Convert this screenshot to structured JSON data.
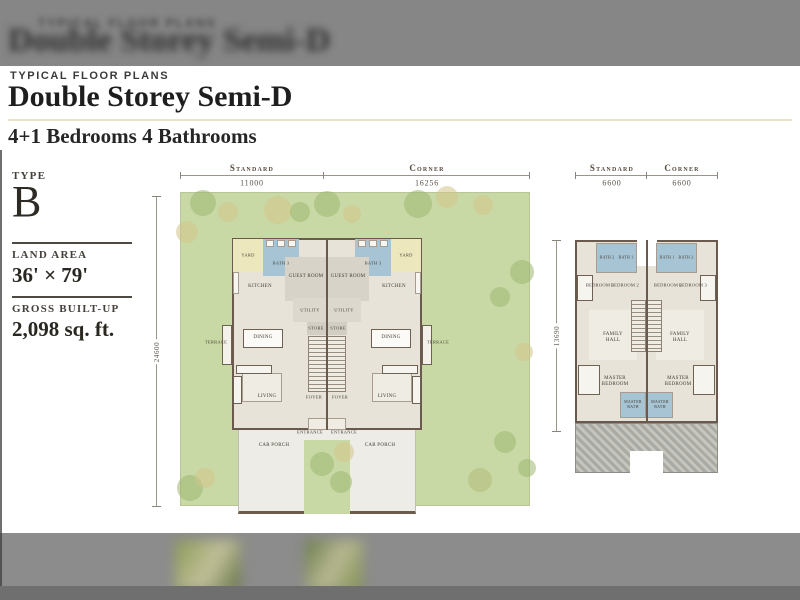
{
  "colors": {
    "accent_rule": "#eae2cb",
    "garden": "#c9d9a5",
    "floor": "#e8e3d8",
    "wall": "#695a4d",
    "yard": "#ece7bd",
    "bath_blue": "#a6c4d4",
    "car_porch": "#edece6",
    "hatch_gray": "#aaaaa4",
    "tree_g": "#9cb873",
    "tree_t": "#d2c48b",
    "tree_o": "#b2b97c"
  },
  "background": {
    "header_eyebrow_blur": "TYPICAL FLOOR PLANS",
    "header_title_blur": "Double Storey Semi-D"
  },
  "page": {
    "eyebrow": "TYPICAL FLOOR PLANS",
    "title": "Double Storey Semi-D",
    "subtitle": "4+1 Bedrooms 4 Bathrooms"
  },
  "panel": {
    "type_label": "TYPE",
    "type_value": "B",
    "land_area_label": "LAND AREA",
    "land_area_value": "36' × 79'",
    "built_up_label": "GROSS BUILT-UP",
    "built_up_value": "2,098 sq. ft."
  },
  "ground_plan": {
    "dims": {
      "standard_label": "Standard",
      "standard_value": "11000",
      "corner_label": "Corner",
      "corner_value": "16256",
      "depth_value": "24600"
    },
    "rects": [
      {
        "n": "garden",
        "x": 0,
        "y": 32,
        "w": 350,
        "h": 314,
        "f": "#c9d9a5",
        "cls": "garden"
      },
      {
        "n": "car-porch",
        "x": 58,
        "y": 265,
        "w": 178,
        "h": 89,
        "f": "#edece6",
        "cls": "porch"
      },
      {
        "n": "porch-green-strip",
        "x": 124,
        "y": 280,
        "w": 46,
        "h": 74,
        "f": "#c9d9a5"
      },
      {
        "n": "building-footprint",
        "x": 52,
        "y": 78,
        "w": 190,
        "h": 192,
        "f": "#e8e3d8",
        "cls": "wall2"
      },
      {
        "n": "yard-left",
        "x": 53,
        "y": 79,
        "w": 30,
        "h": 33,
        "f": "#ece7bd"
      },
      {
        "n": "yard-right",
        "x": 211,
        "y": 79,
        "w": 30,
        "h": 33,
        "f": "#ece7bd"
      },
      {
        "n": "bath3-left",
        "x": 83,
        "y": 79,
        "w": 36,
        "h": 37,
        "f": "#a6c4d4"
      },
      {
        "n": "bath3-right",
        "x": 175,
        "y": 79,
        "w": 36,
        "h": 37,
        "f": "#a6c4d4"
      },
      {
        "n": "wc-fixture",
        "x": 86,
        "y": 80,
        "w": 8,
        "h": 7,
        "f": "#f7f6f1",
        "cls": "thin"
      },
      {
        "n": "wc-fixture",
        "x": 97,
        "y": 80,
        "w": 8,
        "h": 7,
        "f": "#f7f6f1",
        "cls": "thin"
      },
      {
        "n": "wc-fixture",
        "x": 108,
        "y": 80,
        "w": 8,
        "h": 7,
        "f": "#f7f6f1",
        "cls": "thin"
      },
      {
        "n": "wc-fixture",
        "x": 178,
        "y": 80,
        "w": 8,
        "h": 7,
        "f": "#f7f6f1",
        "cls": "thin"
      },
      {
        "n": "wc-fixture",
        "x": 189,
        "y": 80,
        "w": 8,
        "h": 7,
        "f": "#f7f6f1",
        "cls": "thin"
      },
      {
        "n": "wc-fixture",
        "x": 200,
        "y": 80,
        "w": 8,
        "h": 7,
        "f": "#f7f6f1",
        "cls": "thin"
      },
      {
        "n": "guest-room-left",
        "x": 105,
        "y": 97,
        "w": 42,
        "h": 44,
        "f": "#d8d3c8"
      },
      {
        "n": "guest-room-right",
        "x": 147,
        "y": 97,
        "w": 42,
        "h": 44,
        "f": "#d8d3c8"
      },
      {
        "n": "kitchen-counter",
        "x": 53,
        "y": 112,
        "w": 6,
        "h": 22,
        "f": "#f7f6f1",
        "cls": "thin"
      },
      {
        "n": "kitchen-counter",
        "x": 235,
        "y": 112,
        "w": 6,
        "h": 22,
        "f": "#f7f6f1",
        "cls": "thin"
      },
      {
        "n": "utility-left",
        "x": 113,
        "y": 138,
        "w": 34,
        "h": 24,
        "f": "#ddd8cd"
      },
      {
        "n": "utility-right",
        "x": 147,
        "y": 138,
        "w": 34,
        "h": 24,
        "f": "#ddd8cd"
      },
      {
        "n": "store-left",
        "x": 127,
        "y": 162,
        "w": 20,
        "h": 13,
        "f": "#d3cec3"
      },
      {
        "n": "store-right",
        "x": 147,
        "y": 162,
        "w": 20,
        "h": 13,
        "f": "#d3cec3"
      },
      {
        "n": "stairs-left",
        "x": 128,
        "y": 176,
        "w": 19,
        "h": 56,
        "cls": "stairs"
      },
      {
        "n": "stairs-right",
        "x": 147,
        "y": 176,
        "w": 19,
        "h": 56,
        "cls": "stairs"
      },
      {
        "n": "terrace-left",
        "x": 42,
        "y": 165,
        "w": 10,
        "h": 40,
        "f": "#f3f1ea",
        "cls": "wall1"
      },
      {
        "n": "terrace-right",
        "x": 242,
        "y": 165,
        "w": 10,
        "h": 40,
        "f": "#f3f1ea",
        "cls": "wall1"
      },
      {
        "n": "dining-table-left",
        "x": 63,
        "y": 169,
        "w": 40,
        "h": 19,
        "f": "#fbfaf6",
        "cls": "wall1"
      },
      {
        "n": "dining-table-right",
        "x": 191,
        "y": 169,
        "w": 40,
        "h": 19,
        "f": "#fbfaf6",
        "cls": "wall1"
      },
      {
        "n": "living-rug-left",
        "x": 62,
        "y": 213,
        "w": 40,
        "h": 29,
        "f": "#efece3",
        "cls": "thin"
      },
      {
        "n": "living-rug-right",
        "x": 192,
        "y": 213,
        "w": 40,
        "h": 29,
        "f": "#efece3",
        "cls": "thin"
      },
      {
        "n": "sofa-left",
        "x": 56,
        "y": 205,
        "w": 36,
        "h": 9,
        "f": "#f6f4ee",
        "cls": "wall1"
      },
      {
        "n": "sofa-right",
        "x": 202,
        "y": 205,
        "w": 36,
        "h": 9,
        "f": "#f6f4ee",
        "cls": "wall1"
      },
      {
        "n": "sofa-side-left",
        "x": 53,
        "y": 216,
        "w": 9,
        "h": 28,
        "f": "#f6f4ee",
        "cls": "wall1"
      },
      {
        "n": "sofa-side-right",
        "x": 232,
        "y": 216,
        "w": 9,
        "h": 28,
        "f": "#f6f4ee",
        "cls": "wall1"
      },
      {
        "n": "entrance-step",
        "x": 128,
        "y": 258,
        "w": 38,
        "h": 12,
        "f": "#efece4",
        "cls": "thin"
      },
      {
        "n": "party-wall",
        "x": 146,
        "y": 78,
        "w": 2,
        "h": 192,
        "f": "#695a4d"
      }
    ],
    "trees": [
      {
        "x": 23,
        "y": 43,
        "r": 13,
        "c": "g"
      },
      {
        "x": 48,
        "y": 52,
        "r": 10,
        "c": "t"
      },
      {
        "x": 98,
        "y": 50,
        "r": 14,
        "c": "t"
      },
      {
        "x": 120,
        "y": 52,
        "r": 10,
        "c": "g"
      },
      {
        "x": 147,
        "y": 44,
        "r": 13,
        "c": "g"
      },
      {
        "x": 172,
        "y": 54,
        "r": 9,
        "c": "t"
      },
      {
        "x": 238,
        "y": 44,
        "r": 14,
        "c": "g"
      },
      {
        "x": 267,
        "y": 37,
        "r": 11,
        "c": "t"
      },
      {
        "x": 303,
        "y": 45,
        "r": 10,
        "c": "t"
      },
      {
        "x": 7,
        "y": 72,
        "r": 11,
        "c": "t"
      },
      {
        "x": 342,
        "y": 112,
        "r": 12,
        "c": "g"
      },
      {
        "x": 320,
        "y": 137,
        "r": 10,
        "c": "g"
      },
      {
        "x": 344,
        "y": 192,
        "r": 9,
        "c": "t"
      },
      {
        "x": 325,
        "y": 282,
        "r": 11,
        "c": "g"
      },
      {
        "x": 347,
        "y": 308,
        "r": 9,
        "c": "g"
      },
      {
        "x": 142,
        "y": 304,
        "r": 12,
        "c": "g"
      },
      {
        "x": 164,
        "y": 292,
        "r": 10,
        "c": "t"
      },
      {
        "x": 161,
        "y": 322,
        "r": 11,
        "c": "g"
      },
      {
        "x": 10,
        "y": 328,
        "r": 13,
        "c": "g"
      },
      {
        "x": 25,
        "y": 318,
        "r": 10,
        "c": "t"
      },
      {
        "x": 300,
        "y": 320,
        "r": 12,
        "c": "o"
      }
    ],
    "labels": [
      {
        "t": "YARD",
        "x": 68,
        "y": 95,
        "fs": 4.5
      },
      {
        "t": "YARD",
        "x": 226,
        "y": 95,
        "fs": 4.5
      },
      {
        "t": "BATH 3",
        "x": 101,
        "y": 103,
        "fs": 4.5
      },
      {
        "t": "BATH 3",
        "x": 193,
        "y": 103,
        "fs": 4.5
      },
      {
        "t": "GUEST ROOM",
        "x": 126,
        "y": 117,
        "fs": 5
      },
      {
        "t": "GUEST ROOM",
        "x": 168,
        "y": 117,
        "fs": 5
      },
      {
        "t": "KITCHEN",
        "x": 80,
        "y": 127,
        "fs": 5
      },
      {
        "t": "KITCHEN",
        "x": 214,
        "y": 127,
        "fs": 5
      },
      {
        "t": "UTILITY",
        "x": 130,
        "y": 150,
        "fs": 4.5
      },
      {
        "t": "UTILITY",
        "x": 164,
        "y": 150,
        "fs": 4.5
      },
      {
        "t": "STORE",
        "x": 136,
        "y": 168,
        "fs": 4.5
      },
      {
        "t": "STORE",
        "x": 158,
        "y": 168,
        "fs": 4.5
      },
      {
        "t": "DINING",
        "x": 83,
        "y": 178,
        "fs": 5
      },
      {
        "t": "DINING",
        "x": 211,
        "y": 178,
        "fs": 5
      },
      {
        "t": "TERRACE",
        "x": 36,
        "y": 182,
        "fs": 4.5
      },
      {
        "t": "TERRACE",
        "x": 258,
        "y": 182,
        "fs": 4.5
      },
      {
        "t": "LIVING",
        "x": 87,
        "y": 237,
        "fs": 5
      },
      {
        "t": "LIVING",
        "x": 207,
        "y": 237,
        "fs": 5
      },
      {
        "t": "FOYER",
        "x": 134,
        "y": 237,
        "fs": 4.5
      },
      {
        "t": "FOYER",
        "x": 160,
        "y": 237,
        "fs": 4.5
      },
      {
        "t": "ENTRANCE",
        "x": 130,
        "y": 272,
        "fs": 4.5
      },
      {
        "t": "ENTRANCE",
        "x": 164,
        "y": 272,
        "fs": 4.5
      },
      {
        "t": "CAR PORCH",
        "x": 94,
        "y": 286,
        "fs": 5
      },
      {
        "t": "CAR PORCH",
        "x": 200,
        "y": 286,
        "fs": 5
      }
    ]
  },
  "first_plan": {
    "dims": {
      "standard_label": "Standard",
      "standard_value": "6600",
      "corner_label": "Corner",
      "corner_value": "6600",
      "depth_value": "13690"
    },
    "rects": [
      {
        "n": "building-footprint",
        "x": 0,
        "y": 80,
        "w": 143,
        "h": 183,
        "f": "#e8e3d8",
        "cls": "wall2"
      },
      {
        "n": "air-well",
        "x": 62,
        "y": 80,
        "w": 20,
        "h": 26,
        "f": "#ffffff"
      },
      {
        "n": "bath-block-left",
        "x": 21,
        "y": 83,
        "w": 41,
        "h": 30,
        "f": "#a6c4d4",
        "cls": "thin"
      },
      {
        "n": "bath-block-right",
        "x": 81,
        "y": 83,
        "w": 41,
        "h": 30,
        "f": "#a6c4d4",
        "cls": "thin"
      },
      {
        "n": "family-hall-left",
        "x": 14,
        "y": 150,
        "w": 48,
        "h": 50,
        "f": "#efece3"
      },
      {
        "n": "family-hall-right",
        "x": 81,
        "y": 150,
        "w": 48,
        "h": 50,
        "f": "#efece3"
      },
      {
        "n": "stairs-left",
        "x": 56,
        "y": 140,
        "w": 15,
        "h": 52,
        "cls": "stairs"
      },
      {
        "n": "stairs-right",
        "x": 72,
        "y": 140,
        "w": 15,
        "h": 52,
        "cls": "stairs"
      },
      {
        "n": "bed-single-left",
        "x": 2,
        "y": 115,
        "w": 16,
        "h": 26,
        "f": "#f6f4ee",
        "cls": "wall1"
      },
      {
        "n": "bed-single-right",
        "x": 125,
        "y": 115,
        "w": 16,
        "h": 26,
        "f": "#f6f4ee",
        "cls": "wall1"
      },
      {
        "n": "master-bed-left",
        "x": 3,
        "y": 205,
        "w": 22,
        "h": 30,
        "f": "#f6f4ee",
        "cls": "wall1"
      },
      {
        "n": "master-bed-right",
        "x": 118,
        "y": 205,
        "w": 22,
        "h": 30,
        "f": "#f6f4ee",
        "cls": "wall1"
      },
      {
        "n": "master-bath-left",
        "x": 45,
        "y": 232,
        "w": 26,
        "h": 26,
        "f": "#a6c4d4",
        "cls": "thin"
      },
      {
        "n": "master-bath-right",
        "x": 72,
        "y": 232,
        "w": 26,
        "h": 26,
        "f": "#a6c4d4",
        "cls": "thin"
      },
      {
        "n": "party-wall",
        "x": 71,
        "y": 80,
        "w": 2,
        "h": 183,
        "f": "#695a4d"
      },
      {
        "n": "roof-hatch",
        "x": 0,
        "y": 263,
        "w": 143,
        "h": 50,
        "cls": "hatch"
      },
      {
        "n": "roof-notch",
        "x": 55,
        "y": 291,
        "w": 33,
        "h": 22,
        "f": "#ffffff"
      }
    ],
    "trees": [],
    "labels": [
      {
        "t": "BATH 2",
        "x": 32,
        "y": 98,
        "fs": 4
      },
      {
        "t": "BATH 1",
        "x": 51,
        "y": 98,
        "fs": 4
      },
      {
        "t": "BATH 1",
        "x": 92,
        "y": 98,
        "fs": 4
      },
      {
        "t": "BATH 2",
        "x": 111,
        "y": 98,
        "fs": 4
      },
      {
        "t": "BEDROOM 3",
        "x": 25,
        "y": 125,
        "fs": 4.5
      },
      {
        "t": "BEDROOM 2",
        "x": 50,
        "y": 125,
        "fs": 4.5
      },
      {
        "t": "BEDROOM 2",
        "x": 93,
        "y": 125,
        "fs": 4.5
      },
      {
        "t": "BEDROOM 3",
        "x": 118,
        "y": 125,
        "fs": 4.5
      },
      {
        "t": "FAMILY HALL",
        "x": 38,
        "y": 178,
        "fs": 5,
        "w": 30
      },
      {
        "t": "FAMILY HALL",
        "x": 105,
        "y": 178,
        "fs": 5,
        "w": 30
      },
      {
        "t": "MASTER BEDROOM",
        "x": 40,
        "y": 222,
        "fs": 5,
        "w": 38
      },
      {
        "t": "MASTER BEDROOM",
        "x": 103,
        "y": 222,
        "fs": 5,
        "w": 38
      },
      {
        "t": "MASTER BATH",
        "x": 58,
        "y": 245,
        "fs": 4,
        "w": 24
      },
      {
        "t": "MASTER BATH",
        "x": 85,
        "y": 245,
        "fs": 4,
        "w": 24
      }
    ]
  }
}
